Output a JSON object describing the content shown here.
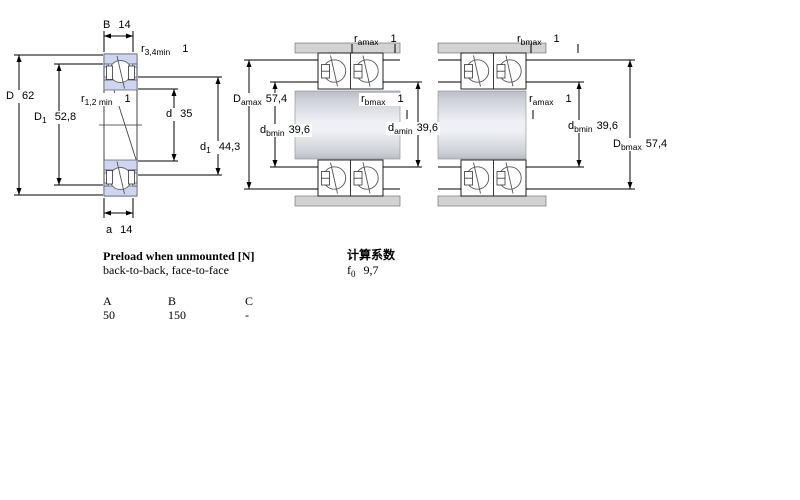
{
  "diagrams": {
    "left": {
      "labels": {
        "B": {
          "base": "B",
          "sub": "",
          "value": "14"
        },
        "r34": {
          "base": "r",
          "sub": "3,4min",
          "value": "1"
        },
        "D": {
          "base": "D",
          "sub": "",
          "value": "62"
        },
        "D1": {
          "base": "D",
          "sub": "1",
          "value": "52,8"
        },
        "r12": {
          "base": "r",
          "sub": "1,2 min",
          "value": "1"
        },
        "d": {
          "base": "d",
          "sub": "",
          "value": "35"
        },
        "d1": {
          "base": "d",
          "sub": "1",
          "value": "44,3"
        },
        "a": {
          "base": "a",
          "sub": "",
          "value": "14"
        }
      }
    },
    "middle": {
      "labels": {
        "ramax": {
          "base": "r",
          "sub": "amax",
          "value": "1"
        },
        "Damax": {
          "base": "D",
          "sub": "amax",
          "value": "57,4"
        },
        "rbmax": {
          "base": "r",
          "sub": "bmax",
          "value": "1"
        },
        "dbmin": {
          "base": "d",
          "sub": "bmin",
          "value": "39,6"
        },
        "damin": {
          "base": "d",
          "sub": "amin",
          "value": "39,6"
        }
      }
    },
    "right": {
      "labels": {
        "rbmax": {
          "base": "r",
          "sub": "bmax",
          "value": "1"
        },
        "ramax": {
          "base": "r",
          "sub": "amax",
          "value": "1"
        },
        "dbmin": {
          "base": "d",
          "sub": "bmin",
          "value": "39,6"
        },
        "Dbmax": {
          "base": "D",
          "sub": "bmax",
          "value": "57,4"
        }
      }
    }
  },
  "preload": {
    "title": "Preload when unmounted [N]",
    "subtitle": "back-to-back, face-to-face",
    "columns": [
      "A",
      "B",
      "C"
    ],
    "values": [
      "50",
      "150",
      "-"
    ]
  },
  "calculation": {
    "title": "计算系数",
    "f0": {
      "base": "f",
      "sub": "0",
      "value": "9,7"
    }
  },
  "colors": {
    "bearing_ring": "#cdd6ee",
    "housing": "#d2d2d2",
    "background": "#ffffff"
  }
}
